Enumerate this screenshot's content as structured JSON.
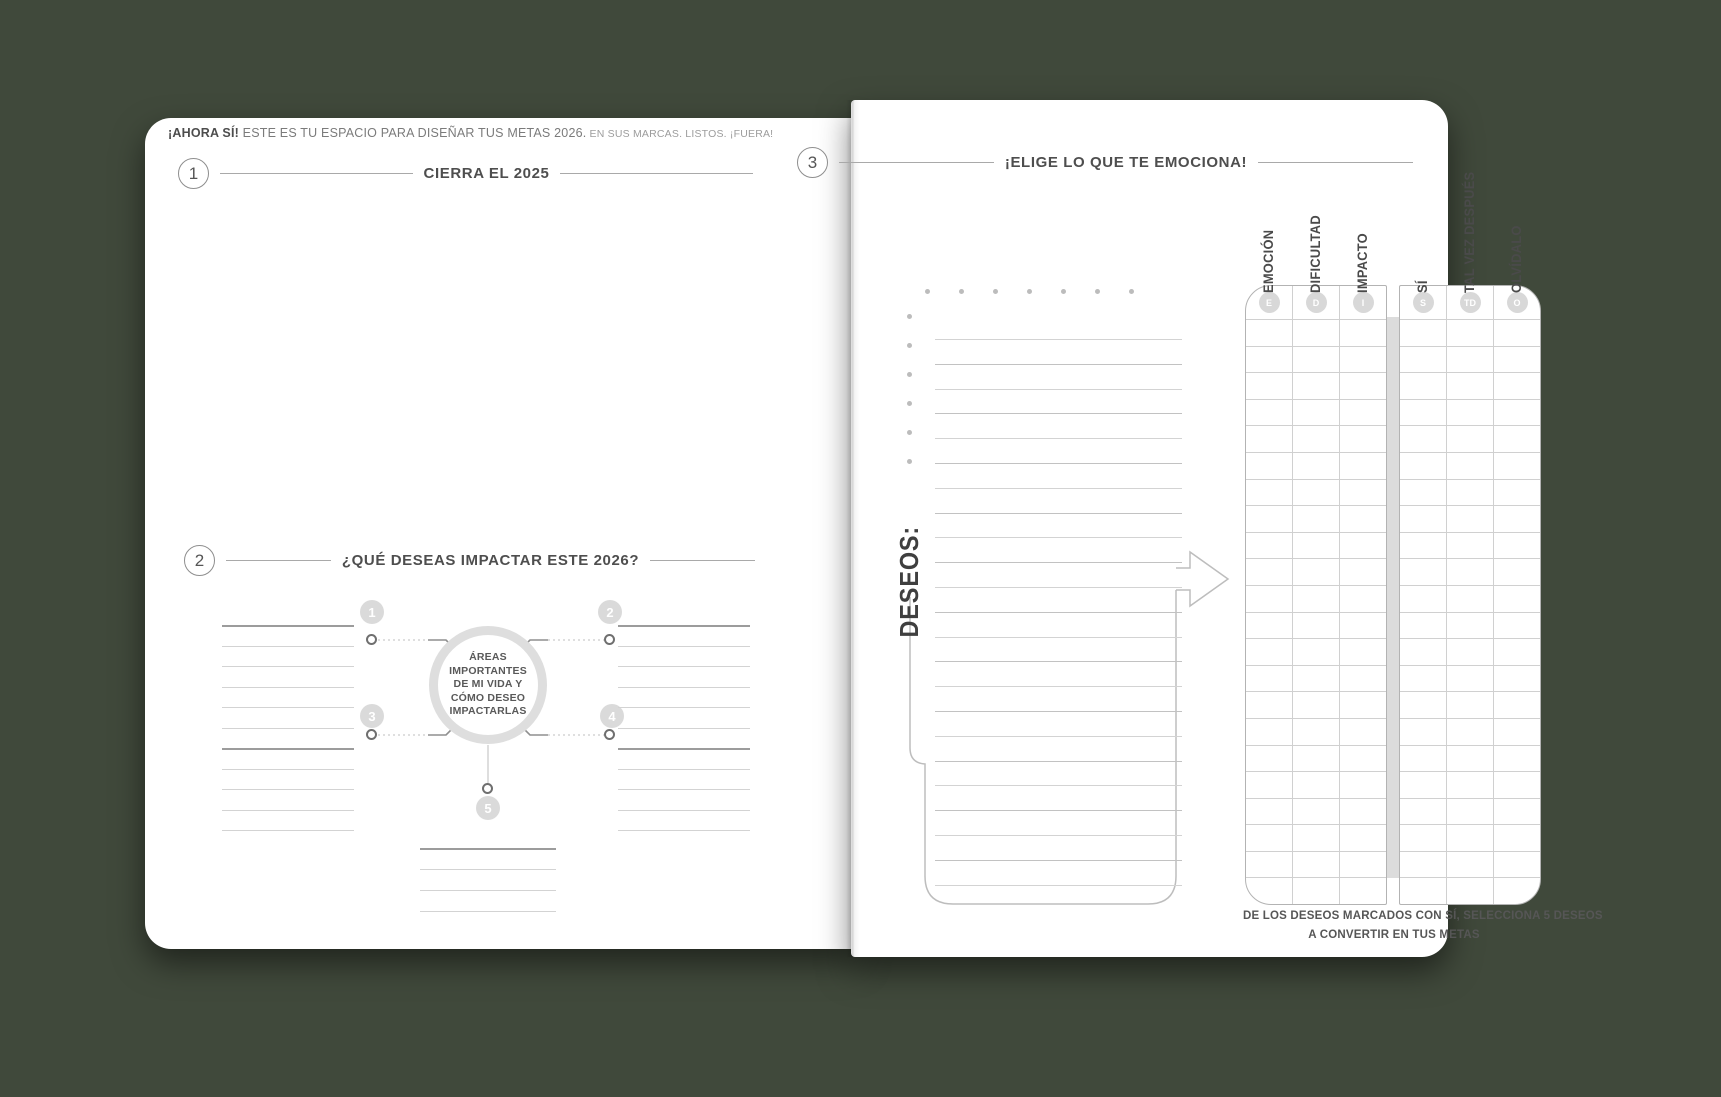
{
  "background_color": "#40493b",
  "left_page": {
    "intro_lead": "¡AHORA SÍ!",
    "intro_main": " ESTE ES TU ESPACIO PARA DISEÑAR TUS METAS 2026.",
    "intro_tail": " EN SUS MARCAS. LISTOS. ¡FUERA!",
    "section1": {
      "number": "1",
      "title": "CIERRA EL 2025"
    },
    "section2": {
      "number": "2",
      "title": "¿QUÉ DESEAS IMPACTAR ESTE 2026?",
      "diagram": {
        "center_text": "ÁREAS IMPORTANTES DE MI VIDA Y CÓMO DESEO IMPACTARLAS",
        "spoke_numbers": [
          "1",
          "2",
          "3",
          "4",
          "5"
        ]
      }
    }
  },
  "right_page": {
    "section3": {
      "number": "3",
      "title": "¡ELIGE LO QUE TE EMOCIONA!"
    },
    "deseos_label": "DESEOS:",
    "table": {
      "column_groups": [
        {
          "name": "criterios",
          "columns": [
            {
              "label": "EMOCIÓN",
              "badge": "E"
            },
            {
              "label": "DIFICULTAD",
              "badge": "D"
            },
            {
              "label": "IMPACTO",
              "badge": "I"
            }
          ]
        },
        {
          "name": "decision",
          "columns": [
            {
              "label": "SÍ",
              "badge": "S"
            },
            {
              "label": "TAL VEZ DESPUÉS",
              "badge": "TD"
            },
            {
              "label": "OLVÍDALO",
              "badge": "O"
            }
          ]
        }
      ],
      "data_rows": 22
    },
    "footer": {
      "line1": "DE LOS DESEOS MARCADOS CON SÍ, SELECCIONA 5 DESEOS",
      "line2": "A CONVERTIR EN TUS METAS"
    }
  }
}
